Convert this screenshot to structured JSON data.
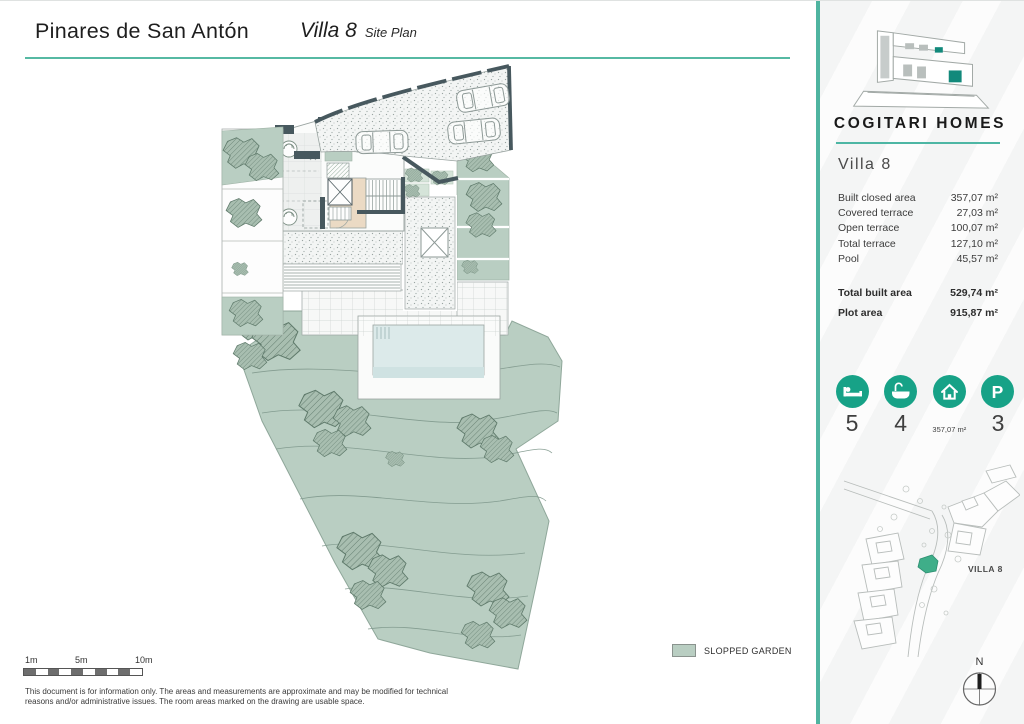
{
  "header": {
    "project_title": "Pinares de San Antón",
    "drawing_title": "Villa 8",
    "drawing_subtitle": "Site Plan"
  },
  "brand": {
    "name": "COGITARI HOMES",
    "logo_icon": "modern-house-logo",
    "accent_color": "#17a287",
    "rule_color": "#4db6a4"
  },
  "sidebar": {
    "villa_title": "Villa 8",
    "details": {
      "rows": [
        {
          "label": "Built closed area",
          "value": "357,07 m²"
        },
        {
          "label": "Covered terrace",
          "value": "27,03 m²"
        },
        {
          "label": "Open terrace",
          "value": "100,07 m²"
        },
        {
          "label": "Total terrace",
          "value": "127,10 m²"
        },
        {
          "label": "Pool",
          "value": "45,57 m²"
        }
      ],
      "totals": [
        {
          "label": "Total built area",
          "value": "529,74 m²"
        },
        {
          "label": "Plot area",
          "value": "915,87 m²"
        }
      ]
    },
    "stats": [
      {
        "icon": "bed-icon",
        "value": "5"
      },
      {
        "icon": "bath-icon",
        "value": "4"
      },
      {
        "icon": "house-icon",
        "value": "357,07 m²"
      },
      {
        "icon": "parking-icon",
        "value": "3"
      }
    ],
    "minimap": {
      "label": "VILLA 8",
      "highlight_color": "#3fae89"
    },
    "north_label": "N"
  },
  "plan": {
    "legend": {
      "label": "SLOPPED GARDEN",
      "swatch_color": "#b9cec2"
    },
    "scale": {
      "labels": [
        "1m",
        "5m",
        "10m"
      ]
    },
    "disclaimer_lines": [
      "This document is for information only. The areas and measurements are approximate and may be modified for technical",
      "reasons and/or administrative issues. The room areas marked on the drawing are usable space."
    ]
  }
}
